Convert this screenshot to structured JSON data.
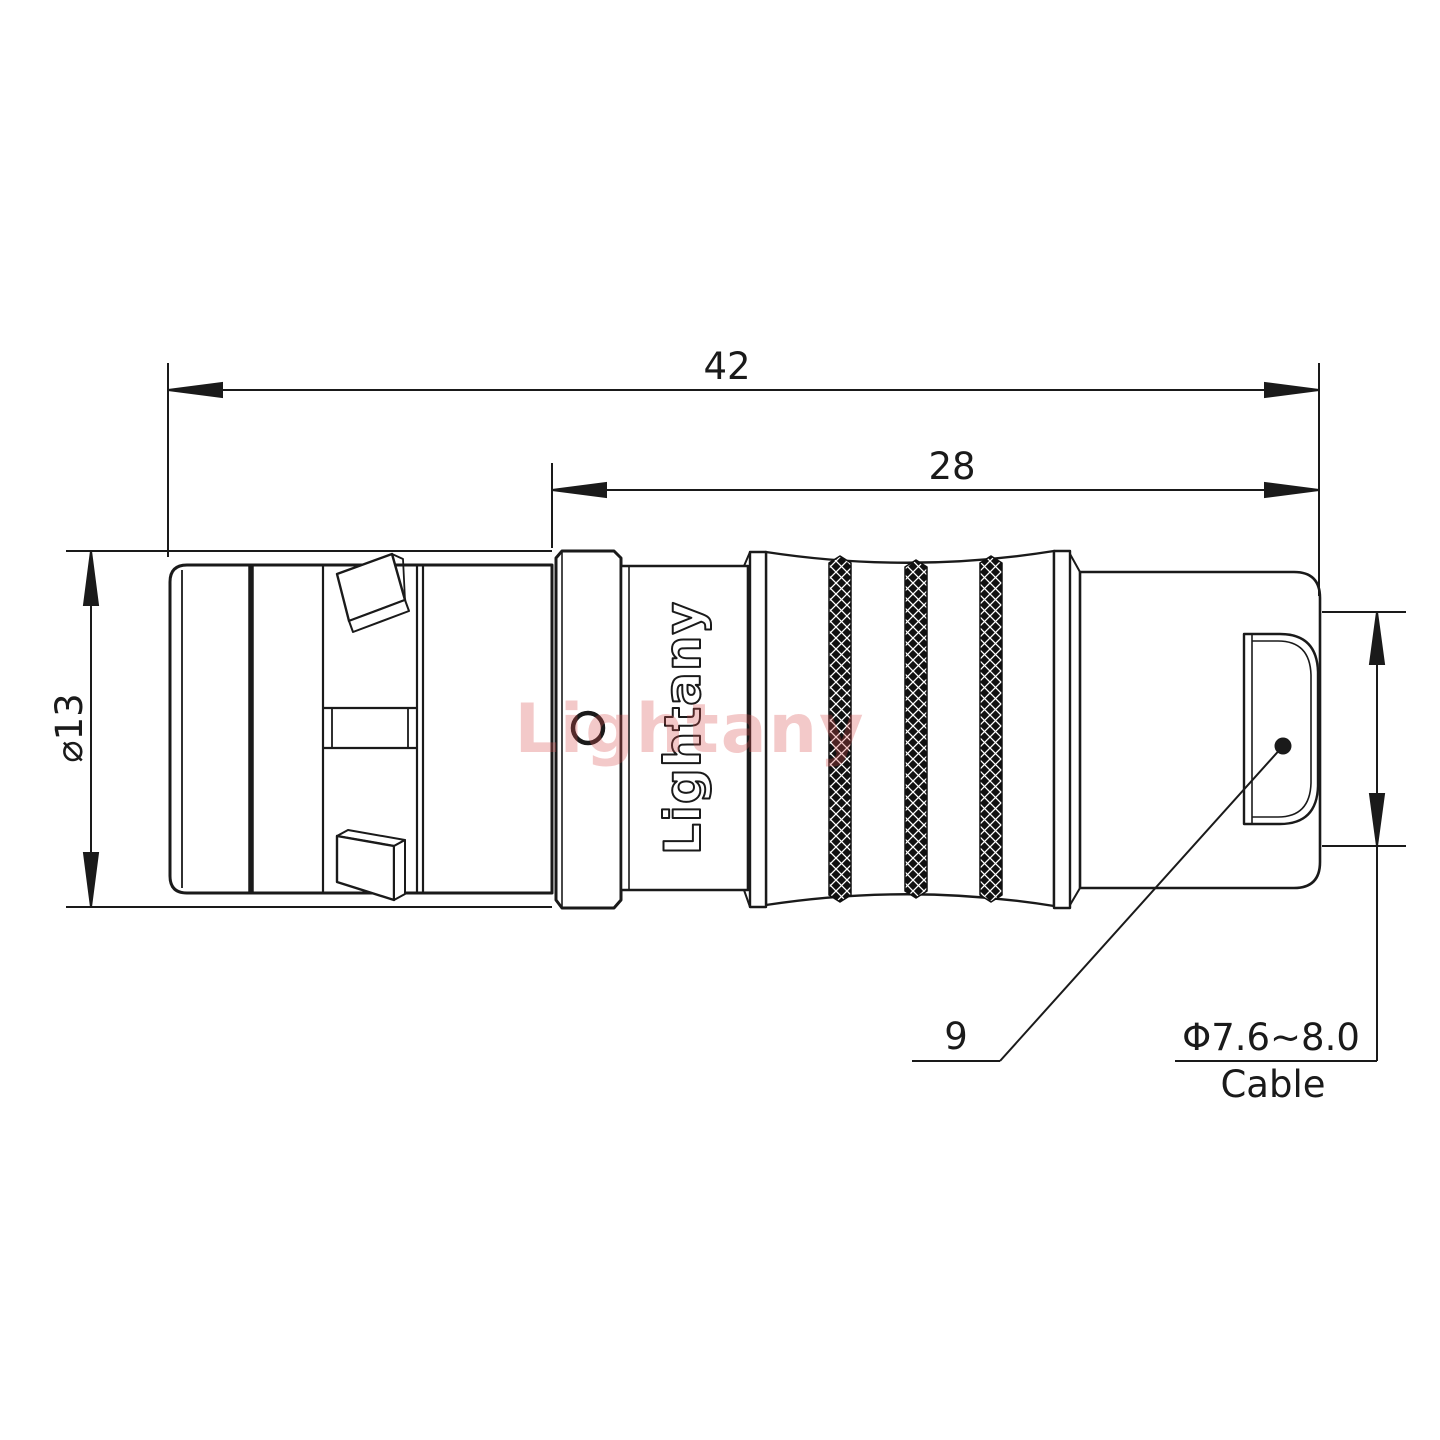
{
  "drawing": {
    "labels": {
      "total_length": "42",
      "rear_length": "28",
      "body_diameter": "⌀13",
      "nut_length": "9",
      "cable_diameter": "Φ7.6~8.0",
      "cable_word": "Cable"
    },
    "watermark": "Lightany",
    "engraving": "Lightany",
    "colors": {
      "line": "#1a1a1a",
      "watermark": "#d94f4f",
      "knurl": "#101010",
      "background": "#ffffff"
    }
  }
}
